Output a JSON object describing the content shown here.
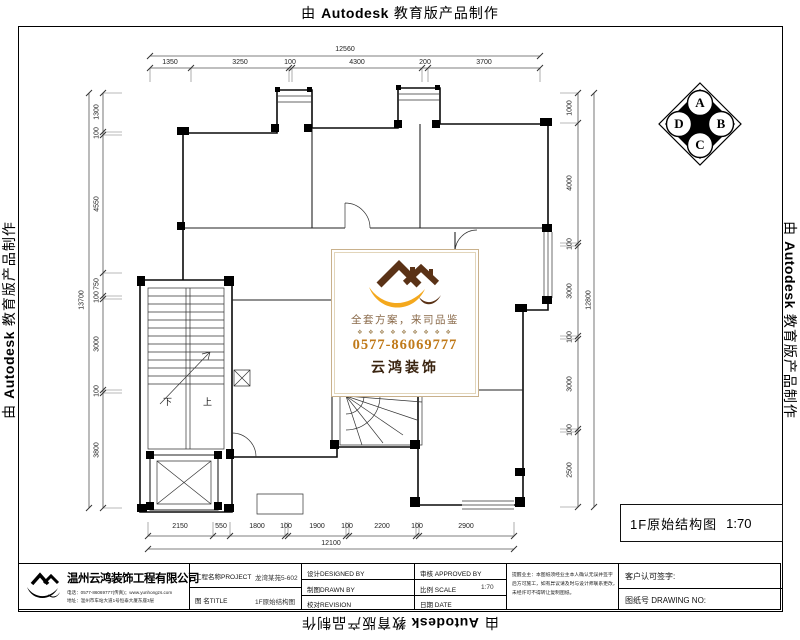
{
  "banner": {
    "prefix": "由",
    "brand": "Autodesk",
    "suffix": "教育版产品制作"
  },
  "compass": {
    "a": "A",
    "b": "B",
    "c": "C",
    "d": "D"
  },
  "watermark": {
    "slogan": "全套方案，来司品鉴",
    "divider": "❖ ❖ ❖ ❖ ❖ ❖ ❖ ❖ ❖",
    "phone": "0577-86069777",
    "brand": "云鸿装饰",
    "colors": {
      "orange": "#f4a81d",
      "brown": "#5a3216",
      "slogan_text": "#8a6a4a",
      "phone_text": "#c07a1a"
    }
  },
  "plan": {
    "stair_down": "下",
    "stair_up": "上"
  },
  "drawing_label": {
    "name": "1F原始结构图",
    "scale": "1:70"
  },
  "dims": {
    "top": [
      "1350",
      "3250",
      "100",
      "4300",
      "200",
      "3700"
    ],
    "top_total": "12560",
    "bottom": [
      "2150",
      "550",
      "1800",
      "100",
      "1900",
      "100",
      "2200",
      "100",
      "2900"
    ],
    "bottom_total": "12100",
    "left": [
      "1300",
      "100",
      "4550",
      "750",
      "100",
      "3000",
      "100",
      "3800"
    ],
    "left_total": "13700",
    "right": [
      "1000",
      "4000",
      "100",
      "3000",
      "100",
      "3000",
      "100",
      "2500"
    ],
    "right_total": "12800"
  },
  "title_block": {
    "company": {
      "name": "温州云鸿装饰工程有限公司",
      "line1": "电话：0577-86069777(传真)；www.yunhongzs.com",
      "line2": "地址：温州市车站大道1号恒泰大厦东座3层"
    },
    "project_label": "工程名称PROJECT",
    "project_value": "龙湾某苑5-602",
    "title_label": "图  名TITLE",
    "title_value": "1F原始结构图",
    "designed": "设计DESIGNED BY",
    "drawn": "制图DRAWN BY",
    "revision": "校对REVISION",
    "approved": "审核  APPROVED BY",
    "scale_label": "比例  SCALE",
    "scale_value": "1:70",
    "date_label": "日期  DATE",
    "notes": [
      "提醒业主：本图纸须经业主本人确认无误并签字",
      "后方可施工，如有异议请及时与设计师联系更改，",
      "未经许可不得转让复制图纸。"
    ],
    "customer_sign": "客户认可签字:",
    "drawing_no": "图纸号 DRAWING NO:"
  }
}
